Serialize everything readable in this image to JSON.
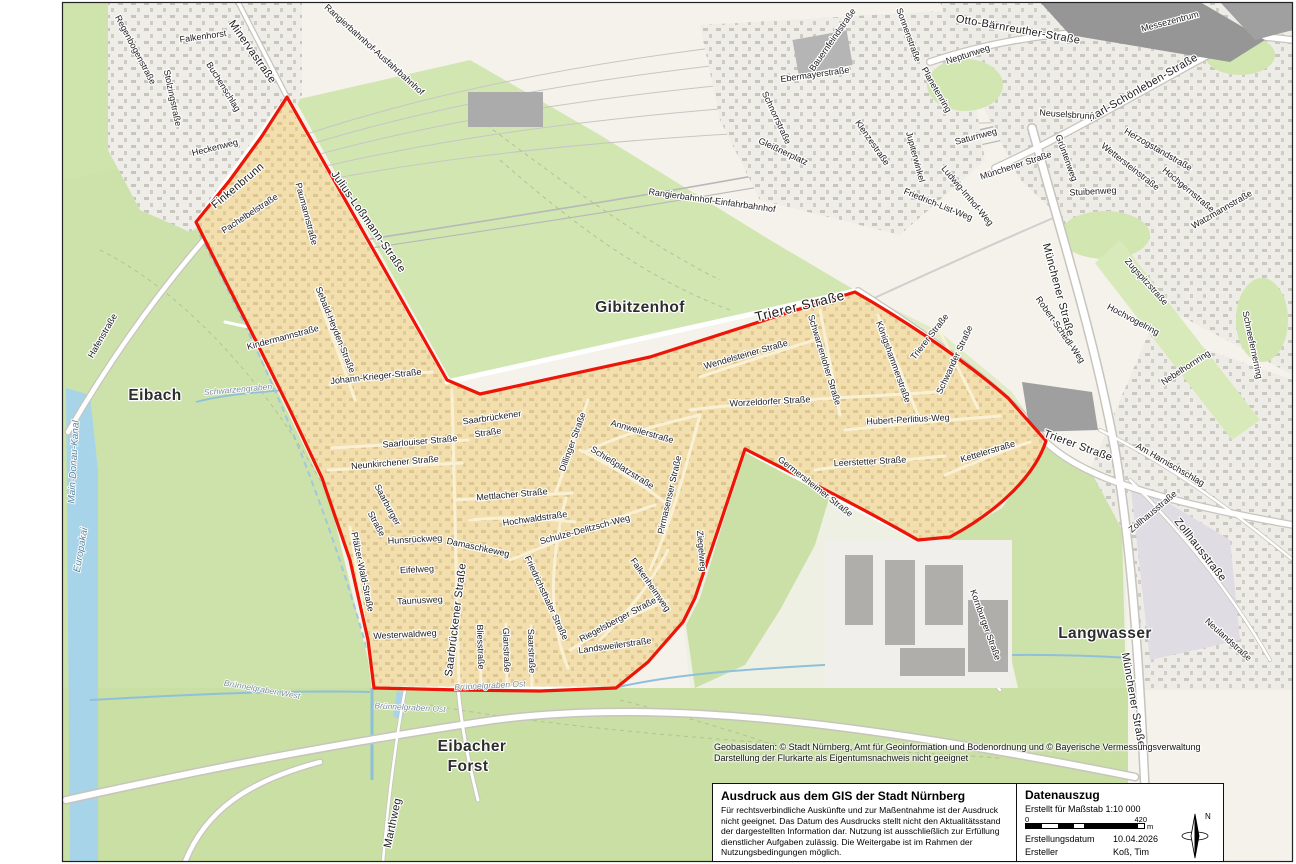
{
  "attribution": {
    "line1": "Geobasisdaten: © Stadt Nürnberg, Amt für Geoinformation und Bodenordnung und © Bayerische Vermessungsverwaltung",
    "line2": "Darstellung der Flurkarte als Eigentumsnachweis nicht geeignet"
  },
  "disclaimer_box": {
    "title": "Ausdruck aus dem GIS der Stadt Nürnberg",
    "body": "Für rechtsverbindliche Auskünfte und zur Maßentnahme ist der Ausdruck nicht geeignet. Das Datum des Ausdrucks stellt nicht den Aktualitätsstand der dargestellten Information dar. Nutzung ist ausschließlich zur Erfüllung dienstlicher Aufgaben zulässig. Die Weitergabe ist im Rahmen der Nutzungsbedingungen möglich."
  },
  "data_box": {
    "title": "Datenauszug",
    "scale_note": "Erstellt für Maßstab 1:10 000",
    "scalebar": {
      "start": "0",
      "end": "420",
      "unit": "m"
    },
    "rows": [
      {
        "label": "Erstellungsdatum",
        "value": "10.04.2026"
      },
      {
        "label": "Ersteller",
        "value": "Koß, Tim"
      }
    ],
    "compass_label": "N"
  },
  "map": {
    "boundary_color": "#ec1507",
    "highlight_fill": "#f2dfad",
    "labels": [
      {
        "t": "Regenbogenstraße",
        "x": 135,
        "y": 50,
        "r": 62,
        "c": "st"
      },
      {
        "t": "Stolzingstraße",
        "x": 172,
        "y": 98,
        "r": 78,
        "c": "st"
      },
      {
        "t": "Falkenhorst",
        "x": 203,
        "y": 37,
        "r": -8,
        "c": "st"
      },
      {
        "t": "Buchenschlag",
        "x": 223,
        "y": 87,
        "r": 58,
        "c": "st"
      },
      {
        "t": "Minervastraße",
        "x": 252,
        "y": 52,
        "r": 55,
        "c": "stm"
      },
      {
        "t": "Heckenweg",
        "x": 215,
        "y": 148,
        "r": -14,
        "c": "st"
      },
      {
        "t": "Finkenbrunn",
        "x": 238,
        "y": 186,
        "r": -40,
        "c": "stm"
      },
      {
        "t": "Julius-Loßmann-Straße",
        "x": 368,
        "y": 222,
        "r": 55,
        "c": "stm"
      },
      {
        "t": "Pachelbelstraße",
        "x": 250,
        "y": 214,
        "r": -33,
        "c": "st"
      },
      {
        "t": "Paumannstraße",
        "x": 306,
        "y": 214,
        "r": 75,
        "c": "st"
      },
      {
        "t": "Rangierbahnhof-Ausfahrbahnhof",
        "x": 374,
        "y": 50,
        "r": 42,
        "c": "st"
      },
      {
        "t": "Rangierbahnhof-Einfahrbahnhof",
        "x": 712,
        "y": 201,
        "r": 8,
        "c": "st"
      },
      {
        "t": "Sonnenstraße",
        "x": 908,
        "y": 35,
        "r": 70,
        "c": "st"
      },
      {
        "t": "Planetenring",
        "x": 936,
        "y": 90,
        "r": 60,
        "c": "st"
      },
      {
        "t": "Ebermayerstraße",
        "x": 815,
        "y": 75,
        "r": -8,
        "c": "st"
      },
      {
        "t": "Bauernfeindstraße",
        "x": 833,
        "y": 40,
        "r": -55,
        "c": "st"
      },
      {
        "t": "Schnorrstraße",
        "x": 776,
        "y": 118,
        "r": 65,
        "c": "st"
      },
      {
        "t": "Gleißnerplatz",
        "x": 783,
        "y": 152,
        "r": 25,
        "c": "st"
      },
      {
        "t": "Klenzestraße",
        "x": 872,
        "y": 143,
        "r": 55,
        "c": "st"
      },
      {
        "t": "Jupiterwinkel",
        "x": 915,
        "y": 157,
        "r": 75,
        "c": "st"
      },
      {
        "t": "Neptunweg",
        "x": 968,
        "y": 55,
        "r": -18,
        "c": "st"
      },
      {
        "t": "Saturnweg",
        "x": 976,
        "y": 137,
        "r": -15,
        "c": "st"
      },
      {
        "t": "Ludwig-Imhof-Weg",
        "x": 967,
        "y": 196,
        "r": 50,
        "c": "st"
      },
      {
        "t": "Friedrich-List-Weg",
        "x": 938,
        "y": 205,
        "r": 22,
        "c": "st"
      },
      {
        "t": "Otto-Bärnreuther-Straße",
        "x": 1018,
        "y": 30,
        "r": 10,
        "c": "stm"
      },
      {
        "t": "Messezentrum",
        "x": 1170,
        "y": 22,
        "r": -15,
        "c": "st"
      },
      {
        "t": "Karl-Schönleben-Straße",
        "x": 1143,
        "y": 88,
        "r": -30,
        "c": "stm"
      },
      {
        "t": "Neuselsbrunn",
        "x": 1067,
        "y": 115,
        "r": 4,
        "c": "st"
      },
      {
        "t": "Münchener Straße",
        "x": 1016,
        "y": 166,
        "r": -18,
        "c": "st"
      },
      {
        "t": "Grüntenweg",
        "x": 1066,
        "y": 158,
        "r": 70,
        "c": "st"
      },
      {
        "t": "Stuibenweg",
        "x": 1093,
        "y": 192,
        "r": -3,
        "c": "st"
      },
      {
        "t": "Wettersteinstraße",
        "x": 1130,
        "y": 167,
        "r": 38,
        "c": "st"
      },
      {
        "t": "Herzogstandstraße",
        "x": 1158,
        "y": 150,
        "r": 30,
        "c": "st"
      },
      {
        "t": "Hochgernstraße",
        "x": 1188,
        "y": 190,
        "r": 40,
        "c": "st"
      },
      {
        "t": "Watzmannstraße",
        "x": 1222,
        "y": 210,
        "r": -30,
        "c": "st"
      },
      {
        "t": "Zugspitzstraße",
        "x": 1146,
        "y": 282,
        "r": 48,
        "c": "st"
      },
      {
        "t": "Hochvogelring",
        "x": 1133,
        "y": 320,
        "r": 28,
        "c": "st"
      },
      {
        "t": "Nebelhornring",
        "x": 1186,
        "y": 368,
        "r": -33,
        "c": "st"
      },
      {
        "t": "Schneefernerring",
        "x": 1252,
        "y": 345,
        "r": 78,
        "c": "st"
      },
      {
        "t": "Robert-Schedl-Weg",
        "x": 1060,
        "y": 330,
        "r": 55,
        "c": "st"
      },
      {
        "t": "Münchener Straße",
        "x": 1058,
        "y": 290,
        "r": 75,
        "c": "stm"
      },
      {
        "t": "Trierer Straße",
        "x": 800,
        "y": 307,
        "r": -14,
        "c": "stl"
      },
      {
        "t": "Trierer Straße",
        "x": 930,
        "y": 337,
        "r": -52,
        "c": "st"
      },
      {
        "t": "Trierer Straße",
        "x": 1078,
        "y": 446,
        "r": 20,
        "c": "stm"
      },
      {
        "t": "Schwarzenloher Straße",
        "x": 824,
        "y": 360,
        "r": 73,
        "c": "st"
      },
      {
        "t": "Königshammerstraße",
        "x": 893,
        "y": 362,
        "r": 70,
        "c": "st"
      },
      {
        "t": "Schwander Straße",
        "x": 955,
        "y": 360,
        "r": -65,
        "c": "st"
      },
      {
        "t": "Hubert-Perlitius-Weg",
        "x": 908,
        "y": 420,
        "r": -3,
        "c": "st"
      },
      {
        "t": "Wendelsteiner Straße",
        "x": 746,
        "y": 355,
        "r": -16,
        "c": "st"
      },
      {
        "t": "Worzeldorfer Straße",
        "x": 770,
        "y": 402,
        "r": -3,
        "c": "st"
      },
      {
        "t": "Leerstetter Straße",
        "x": 870,
        "y": 462,
        "r": -3,
        "c": "st"
      },
      {
        "t": "Kettelerstraße",
        "x": 988,
        "y": 452,
        "r": -17,
        "c": "st"
      },
      {
        "t": "Germersheimer Straße",
        "x": 815,
        "y": 487,
        "r": 38,
        "c": "st"
      },
      {
        "t": "Gibitzenhof",
        "x": 640,
        "y": 308,
        "r": 0,
        "c": "di"
      },
      {
        "t": "Eibach",
        "x": 155,
        "y": 396,
        "r": 0,
        "c": "di"
      },
      {
        "t": "Langwasser",
        "x": 1105,
        "y": 634,
        "r": 0,
        "c": "di"
      },
      {
        "t": "Eibacher",
        "x": 472,
        "y": 747,
        "r": 0,
        "c": "di"
      },
      {
        "t": "Forst",
        "x": 468,
        "y": 767,
        "r": 0,
        "c": "di"
      },
      {
        "t": "Hafenstraße",
        "x": 103,
        "y": 336,
        "r": -60,
        "c": "st"
      },
      {
        "t": "Main-Donau-Kanal",
        "x": 74,
        "y": 462,
        "r": -87,
        "c": "wa"
      },
      {
        "t": "Europakai",
        "x": 81,
        "y": 550,
        "r": -80,
        "c": "wa"
      },
      {
        "t": "Schwarzengraben",
        "x": 238,
        "y": 390,
        "r": -5,
        "c": "sm"
      },
      {
        "t": "Kindermannstraße",
        "x": 283,
        "y": 338,
        "r": -15,
        "c": "st"
      },
      {
        "t": "Sebald-Heyden-Straße",
        "x": 335,
        "y": 330,
        "r": 68,
        "c": "st"
      },
      {
        "t": "Johann-Krieger-Straße",
        "x": 376,
        "y": 377,
        "r": -6,
        "c": "st"
      },
      {
        "t": "Saarbrückener",
        "x": 492,
        "y": 418,
        "r": -8,
        "c": "st"
      },
      {
        "t": "Straße",
        "x": 488,
        "y": 433,
        "r": -8,
        "c": "st"
      },
      {
        "t": "Saarlouiser Straße",
        "x": 420,
        "y": 442,
        "r": -5,
        "c": "st"
      },
      {
        "t": "Neunkirchener Straße",
        "x": 395,
        "y": 463,
        "r": -5,
        "c": "st"
      },
      {
        "t": "Mettlacher Straße",
        "x": 512,
        "y": 495,
        "r": -5,
        "c": "st"
      },
      {
        "t": "Dillinger Straße",
        "x": 573,
        "y": 442,
        "r": -70,
        "c": "st"
      },
      {
        "t": "Hochwaldstraße",
        "x": 535,
        "y": 519,
        "r": -8,
        "c": "st"
      },
      {
        "t": "Saarburger",
        "x": 387,
        "y": 505,
        "r": 62,
        "c": "st"
      },
      {
        "t": "Straße",
        "x": 376,
        "y": 524,
        "r": 62,
        "c": "st"
      },
      {
        "t": "Pfälzer-Wald-Straße",
        "x": 362,
        "y": 572,
        "r": 78,
        "c": "st"
      },
      {
        "t": "Hunsrückweg",
        "x": 415,
        "y": 540,
        "r": -3,
        "c": "st"
      },
      {
        "t": "Damaschkeweg",
        "x": 478,
        "y": 548,
        "r": 12,
        "c": "st"
      },
      {
        "t": "Eifelweg",
        "x": 417,
        "y": 570,
        "r": -3,
        "c": "st"
      },
      {
        "t": "Taunusweg",
        "x": 420,
        "y": 601,
        "r": -3,
        "c": "st"
      },
      {
        "t": "Westerwaldweg",
        "x": 405,
        "y": 635,
        "r": -3,
        "c": "st"
      },
      {
        "t": "Saarbrückener Straße",
        "x": 456,
        "y": 620,
        "r": -83,
        "c": "stm"
      },
      {
        "t": "Bliesstraße",
        "x": 480,
        "y": 647,
        "r": 88,
        "c": "st"
      },
      {
        "t": "Glanstraße",
        "x": 506,
        "y": 650,
        "r": 88,
        "c": "st"
      },
      {
        "t": "Saarstraße",
        "x": 531,
        "y": 651,
        "r": 88,
        "c": "st"
      },
      {
        "t": "Friedrichsthaler Straße",
        "x": 546,
        "y": 598,
        "r": 65,
        "c": "st"
      },
      {
        "t": "Schulze-Delitzsch-Weg",
        "x": 585,
        "y": 530,
        "r": -15,
        "c": "st"
      },
      {
        "t": "Falkenheimweg",
        "x": 650,
        "y": 585,
        "r": 55,
        "c": "st"
      },
      {
        "t": "Riegelsberger Straße",
        "x": 618,
        "y": 620,
        "r": -28,
        "c": "st"
      },
      {
        "t": "Landsweilerstraße",
        "x": 615,
        "y": 646,
        "r": -8,
        "c": "st"
      },
      {
        "t": "Ziegelweg",
        "x": 701,
        "y": 551,
        "r": 85,
        "c": "st"
      },
      {
        "t": "Pirmasenser Straße",
        "x": 670,
        "y": 495,
        "r": -77,
        "c": "st"
      },
      {
        "t": "Schießplatzstraße",
        "x": 622,
        "y": 468,
        "r": 32,
        "c": "st"
      },
      {
        "t": "Annweilerstraße",
        "x": 642,
        "y": 432,
        "r": 16,
        "c": "st"
      },
      {
        "t": "Am Harnischschlag",
        "x": 1170,
        "y": 465,
        "r": 30,
        "c": "st"
      },
      {
        "t": "Zollhausstraße",
        "x": 1153,
        "y": 512,
        "r": -40,
        "c": "st"
      },
      {
        "t": "Zollhausstraße",
        "x": 1200,
        "y": 550,
        "r": 52,
        "c": "stm"
      },
      {
        "t": "Neulandstraße",
        "x": 1228,
        "y": 640,
        "r": 42,
        "c": "st"
      },
      {
        "t": "Kornburger Straße",
        "x": 985,
        "y": 625,
        "r": 70,
        "c": "st"
      },
      {
        "t": "Münchener Straße",
        "x": 1133,
        "y": 700,
        "r": 80,
        "c": "stm"
      },
      {
        "t": "Brünnelgraben Ost",
        "x": 490,
        "y": 686,
        "r": -3,
        "c": "sm"
      },
      {
        "t": "Brünnelgraben Ost",
        "x": 410,
        "y": 708,
        "r": 3,
        "c": "sm"
      },
      {
        "t": "Brünnelgraben West",
        "x": 262,
        "y": 690,
        "r": 10,
        "c": "sm"
      },
      {
        "t": "Marthweg",
        "x": 393,
        "y": 823,
        "r": -78,
        "c": "stm"
      }
    ]
  }
}
